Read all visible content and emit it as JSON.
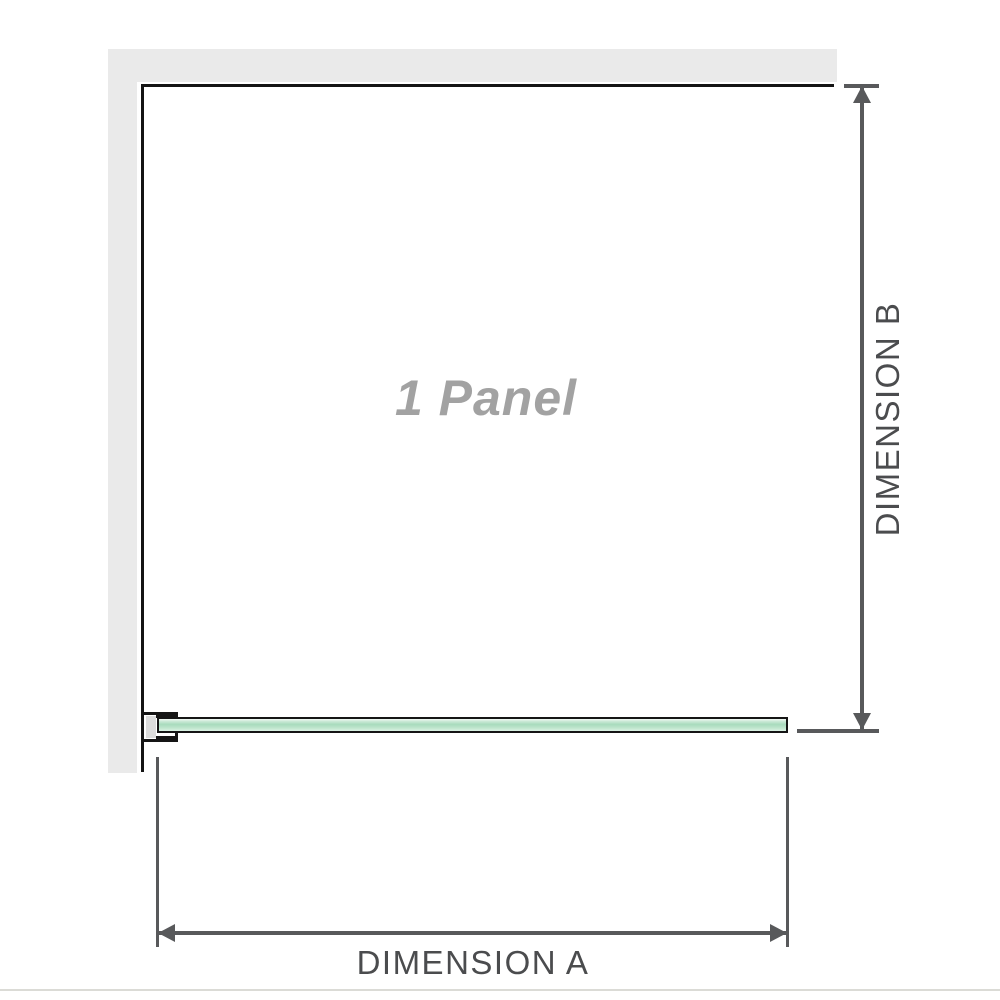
{
  "diagram": {
    "title": "1 Panel shower screen dimension diagram",
    "panel_label": "1 Panel",
    "dimension_a": {
      "label": "DIMENSION A",
      "orientation": "horizontal",
      "position": "bottom"
    },
    "dimension_b": {
      "label": "DIMENSION B",
      "orientation": "vertical",
      "position": "right"
    },
    "colors": {
      "wall_gray": "#eaeaea",
      "outline_black": "#141414",
      "dimension_line": "#58595b",
      "glass_green": "#a8dbbd",
      "glass_green_light": "#dcf2e5",
      "panel_label_gray": "#a2a2a2",
      "dimension_text": "#4b4c4e",
      "divider_gray": "#dbdbd6"
    }
  }
}
